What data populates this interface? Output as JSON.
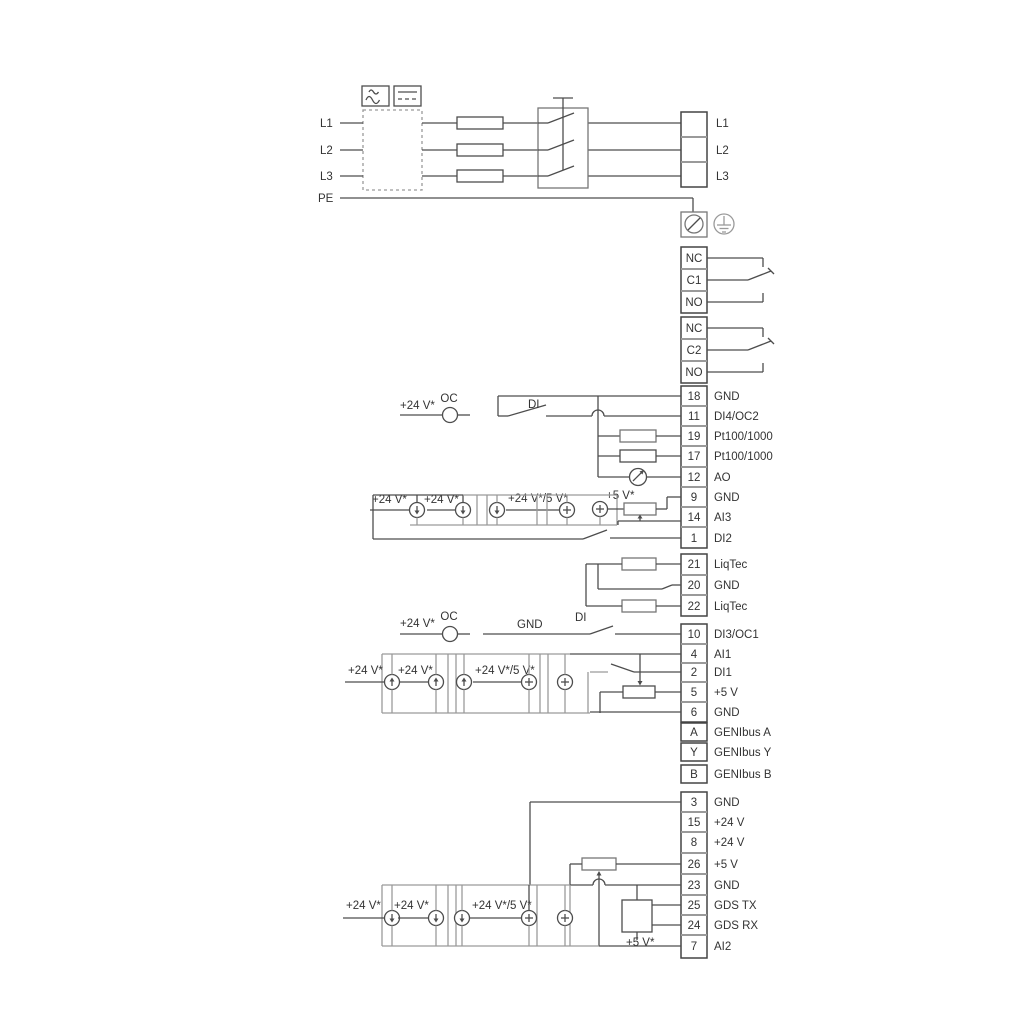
{
  "labels": {
    "v24": "+24 V*",
    "v24v5": "+24 V*/5 V*",
    "v5": "+5 V*",
    "oc": "OC",
    "di": "DI",
    "gnd": "GND"
  },
  "mains_in": {
    "l1": "L1",
    "l2": "L2",
    "l3": "L3",
    "pe": "PE"
  },
  "mains_out": {
    "l1": "L1",
    "l2": "L2",
    "l3": "L3"
  },
  "relay1": {
    "r0": "NC",
    "r1": "C1",
    "r2": "NO"
  },
  "relay2": {
    "r0": "NC",
    "r1": "C2",
    "r2": "NO"
  },
  "io1": [
    {
      "num": "18",
      "label": "GND"
    },
    {
      "num": "11",
      "label": "DI4/OC2"
    },
    {
      "num": "19",
      "label": "Pt100/1000"
    },
    {
      "num": "17",
      "label": "Pt100/1000"
    },
    {
      "num": "12",
      "label": "AO"
    },
    {
      "num": "9",
      "label": "GND"
    },
    {
      "num": "14",
      "label": "AI3"
    },
    {
      "num": "1",
      "label": "DI2"
    }
  ],
  "liqtec": [
    {
      "num": "21",
      "label": "LiqTec"
    },
    {
      "num": "20",
      "label": "GND"
    },
    {
      "num": "22",
      "label": "LiqTec"
    }
  ],
  "io2": [
    {
      "num": "10",
      "label": "DI3/OC1"
    },
    {
      "num": "4",
      "label": "AI1"
    },
    {
      "num": "2",
      "label": "DI1"
    },
    {
      "num": "5",
      "label": "+5 V"
    },
    {
      "num": "6",
      "label": "GND"
    }
  ],
  "genibus": [
    {
      "num": "A",
      "label": "GENIbus A"
    },
    {
      "num": "Y",
      "label": "GENIbus Y"
    },
    {
      "num": "B",
      "label": "GENIbus B"
    }
  ],
  "io3": [
    {
      "num": "3",
      "label": "GND"
    },
    {
      "num": "15",
      "label": "+24 V"
    },
    {
      "num": "8",
      "label": "+24 V"
    },
    {
      "num": "26",
      "label": "+5 V"
    },
    {
      "num": "23",
      "label": "GND"
    },
    {
      "num": "25",
      "label": "GDS TX"
    },
    {
      "num": "24",
      "label": "GDS RX"
    },
    {
      "num": "7",
      "label": "AI2"
    }
  ],
  "colors": {
    "line_dark": "#4d4d4d",
    "line_gray": "#9a9a9a",
    "text": "#333333"
  }
}
